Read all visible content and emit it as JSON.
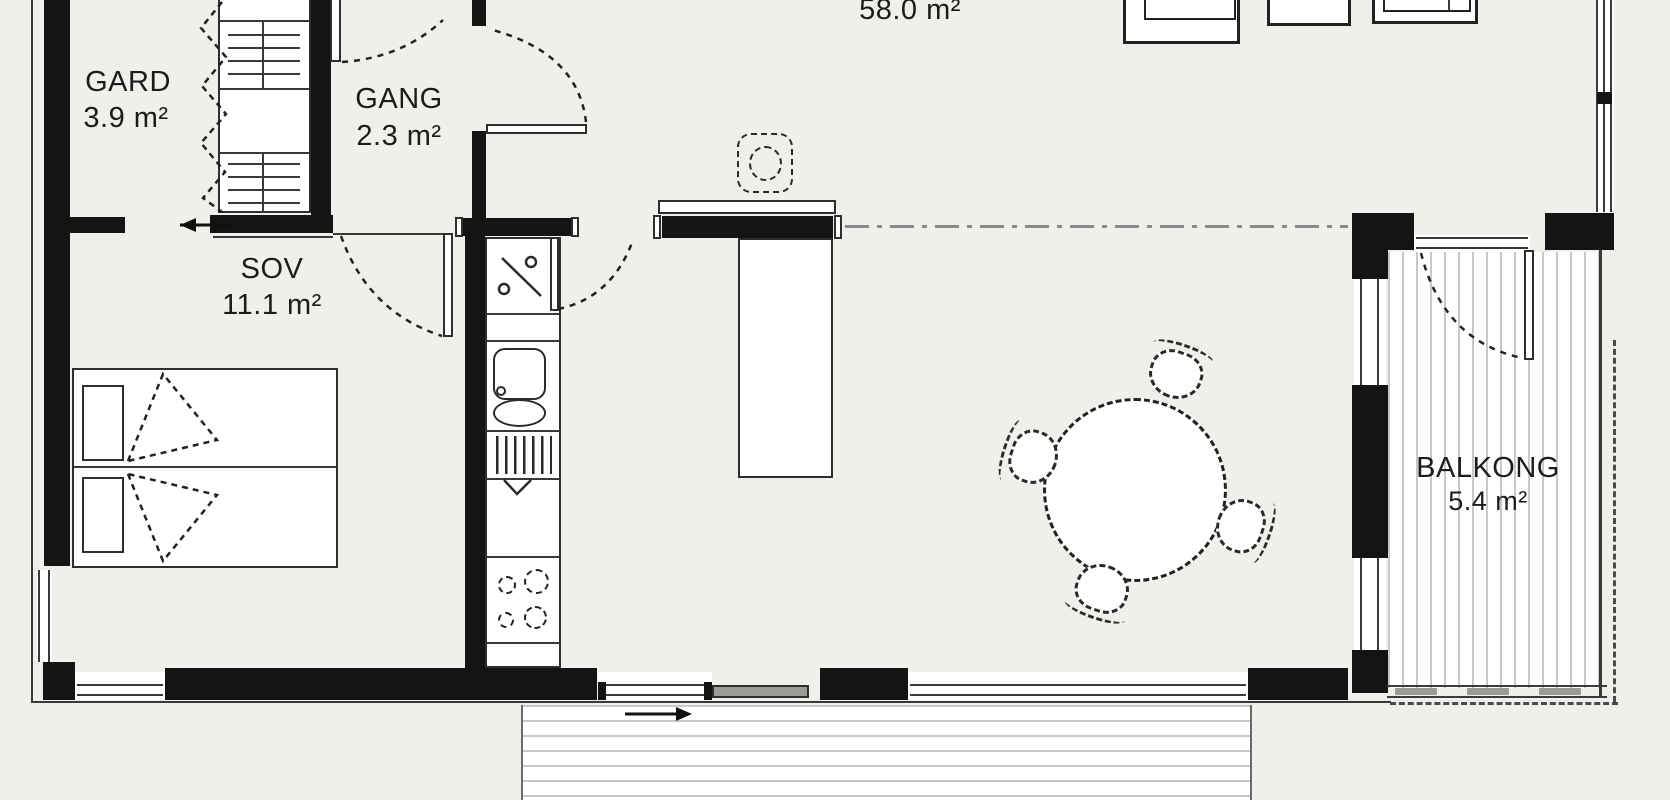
{
  "plan": {
    "title": "Apartment floor plan",
    "rooms": [
      {
        "name": "GARD",
        "area": "3.9 m²"
      },
      {
        "name": "GANG",
        "area": "2.3 m²"
      },
      {
        "name": "SOV",
        "area": "11.1 m²"
      },
      {
        "name": "",
        "area": "58.0 m²"
      },
      {
        "name": "BALKONG",
        "area": "5.4 m²"
      }
    ],
    "symbols": {
      "bed": "double-bed",
      "wardrobe": "wardrobe-shelves",
      "kitchen": [
        "tall-cabinet",
        "sink",
        "dishwasher",
        "cooktop-4-burners",
        "island",
        "hood"
      ],
      "dining": "round-table-4-chairs",
      "arrows": [
        "entry-arrow-left",
        "terrace-arrow-right"
      ]
    },
    "colors": {
      "background": "#f0efeb",
      "wall": "#141414",
      "line": "#2e2e2e",
      "deck_stripe": "#c9c9c4",
      "dashdot": "#8a8a8a",
      "sliding_panel": "#9b9b97"
    }
  }
}
